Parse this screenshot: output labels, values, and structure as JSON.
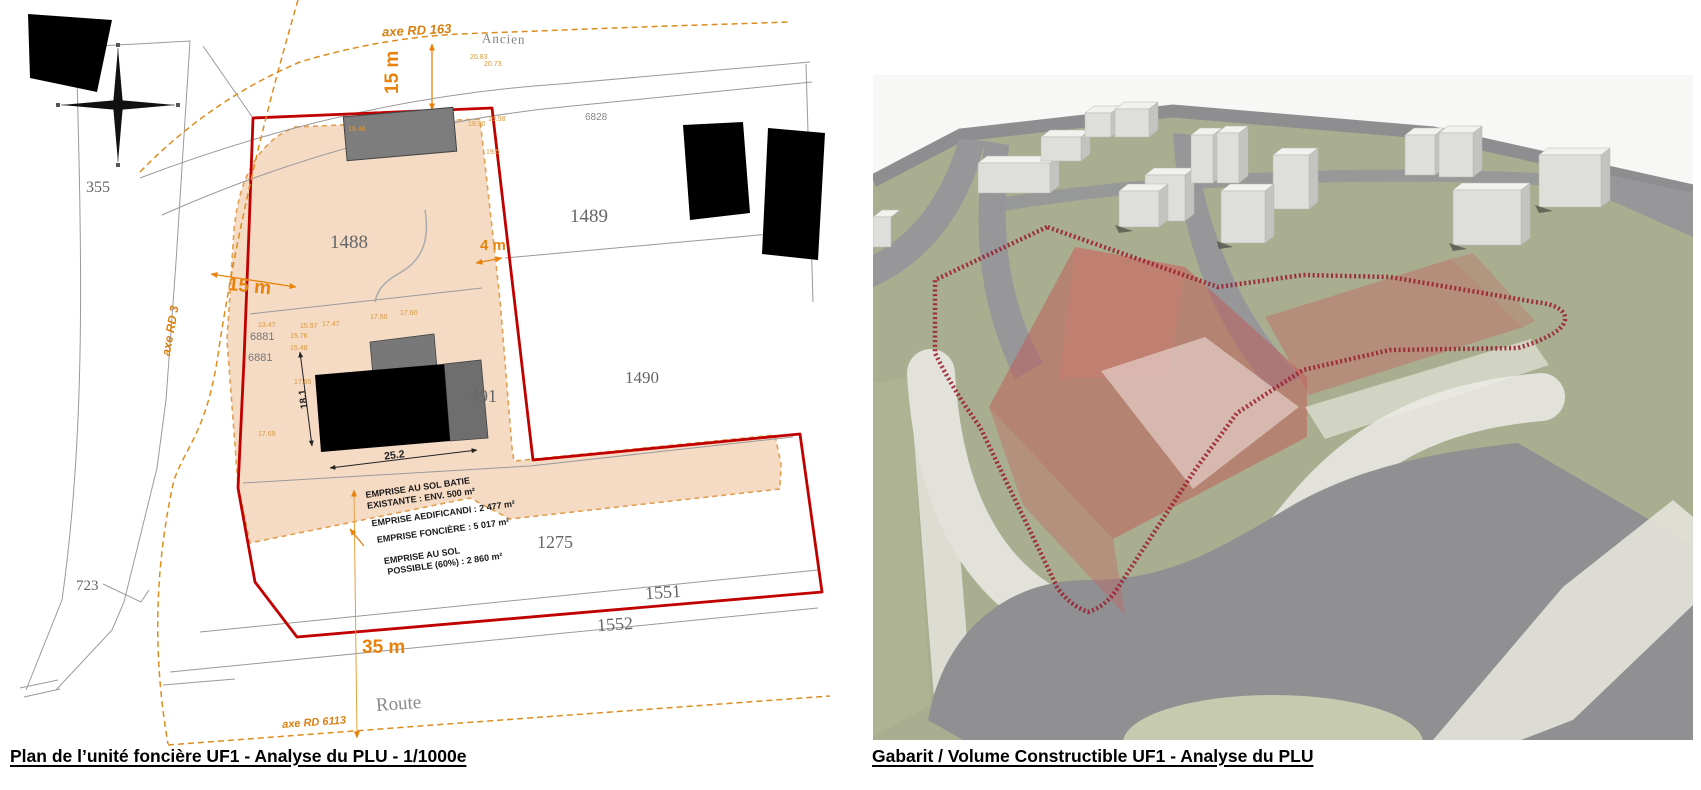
{
  "captions": {
    "left": "Plan de l’unité foncière UF1 - Analyse du PLU - 1/1000e",
    "right": "Gabarit / Volume Constructible UF1 - Analyse du PLU"
  },
  "plan": {
    "parcels": {
      "p355": "355",
      "p1488": "1488",
      "p1489": "1489",
      "p1490": "1490",
      "p491": "491",
      "p1275": "1275",
      "p1551": "1551",
      "p1552": "1552",
      "p723": "723",
      "p6828": "6828",
      "p6881a": "6881",
      "p6881b": "6881"
    },
    "roads": {
      "rd163": "axe RD 163",
      "ancien": "Ancien",
      "rd3": "axe RD 3",
      "rd6113": "axe RD 6113",
      "route": "Route"
    },
    "dims": {
      "top_setback": "15 m",
      "left_setback": "15 m",
      "right_setback": "4 m",
      "bottom_setback": "35 m",
      "bldg_width": "25.2",
      "bldg_depth": "18.1"
    },
    "elev": {
      "e01": "20.83",
      "e02": "20.73",
      "e03": "19.46",
      "e04": "19.90",
      "e05": "19.98",
      "e06": "19.5",
      "e07": "13.47",
      "e08": "15.97",
      "e09": "17.47",
      "e10": "17.50",
      "e11": "17.60",
      "e12": "15.76",
      "e13": "15.48",
      "e14": "17.55",
      "e15": "17.69"
    },
    "legend": {
      "l1": "EMPRISE AU SOL BATIE",
      "l2": "EXISTANTE : ENV. 500 m²",
      "l3": "EMPRISE AEDIFICANDI : 2 477 m²",
      "l4": "EMPRISE FONCIÈRE : 5 017 m²",
      "l5": "EMPRISE AU SOL",
      "l6": "POSSIBLE (60%) : 2 860 m²"
    }
  },
  "colors": {
    "boundary_red": "#c10000",
    "axis_orange": "#d97f10",
    "dimension_orange": "#e8820a",
    "elevation_orange": "#d89a3f",
    "parcel_fill_salmon": "#f3d4ba",
    "hatch_red": "#9b2030",
    "ground_green": "#a9ae90",
    "road_gray": "#939396"
  }
}
